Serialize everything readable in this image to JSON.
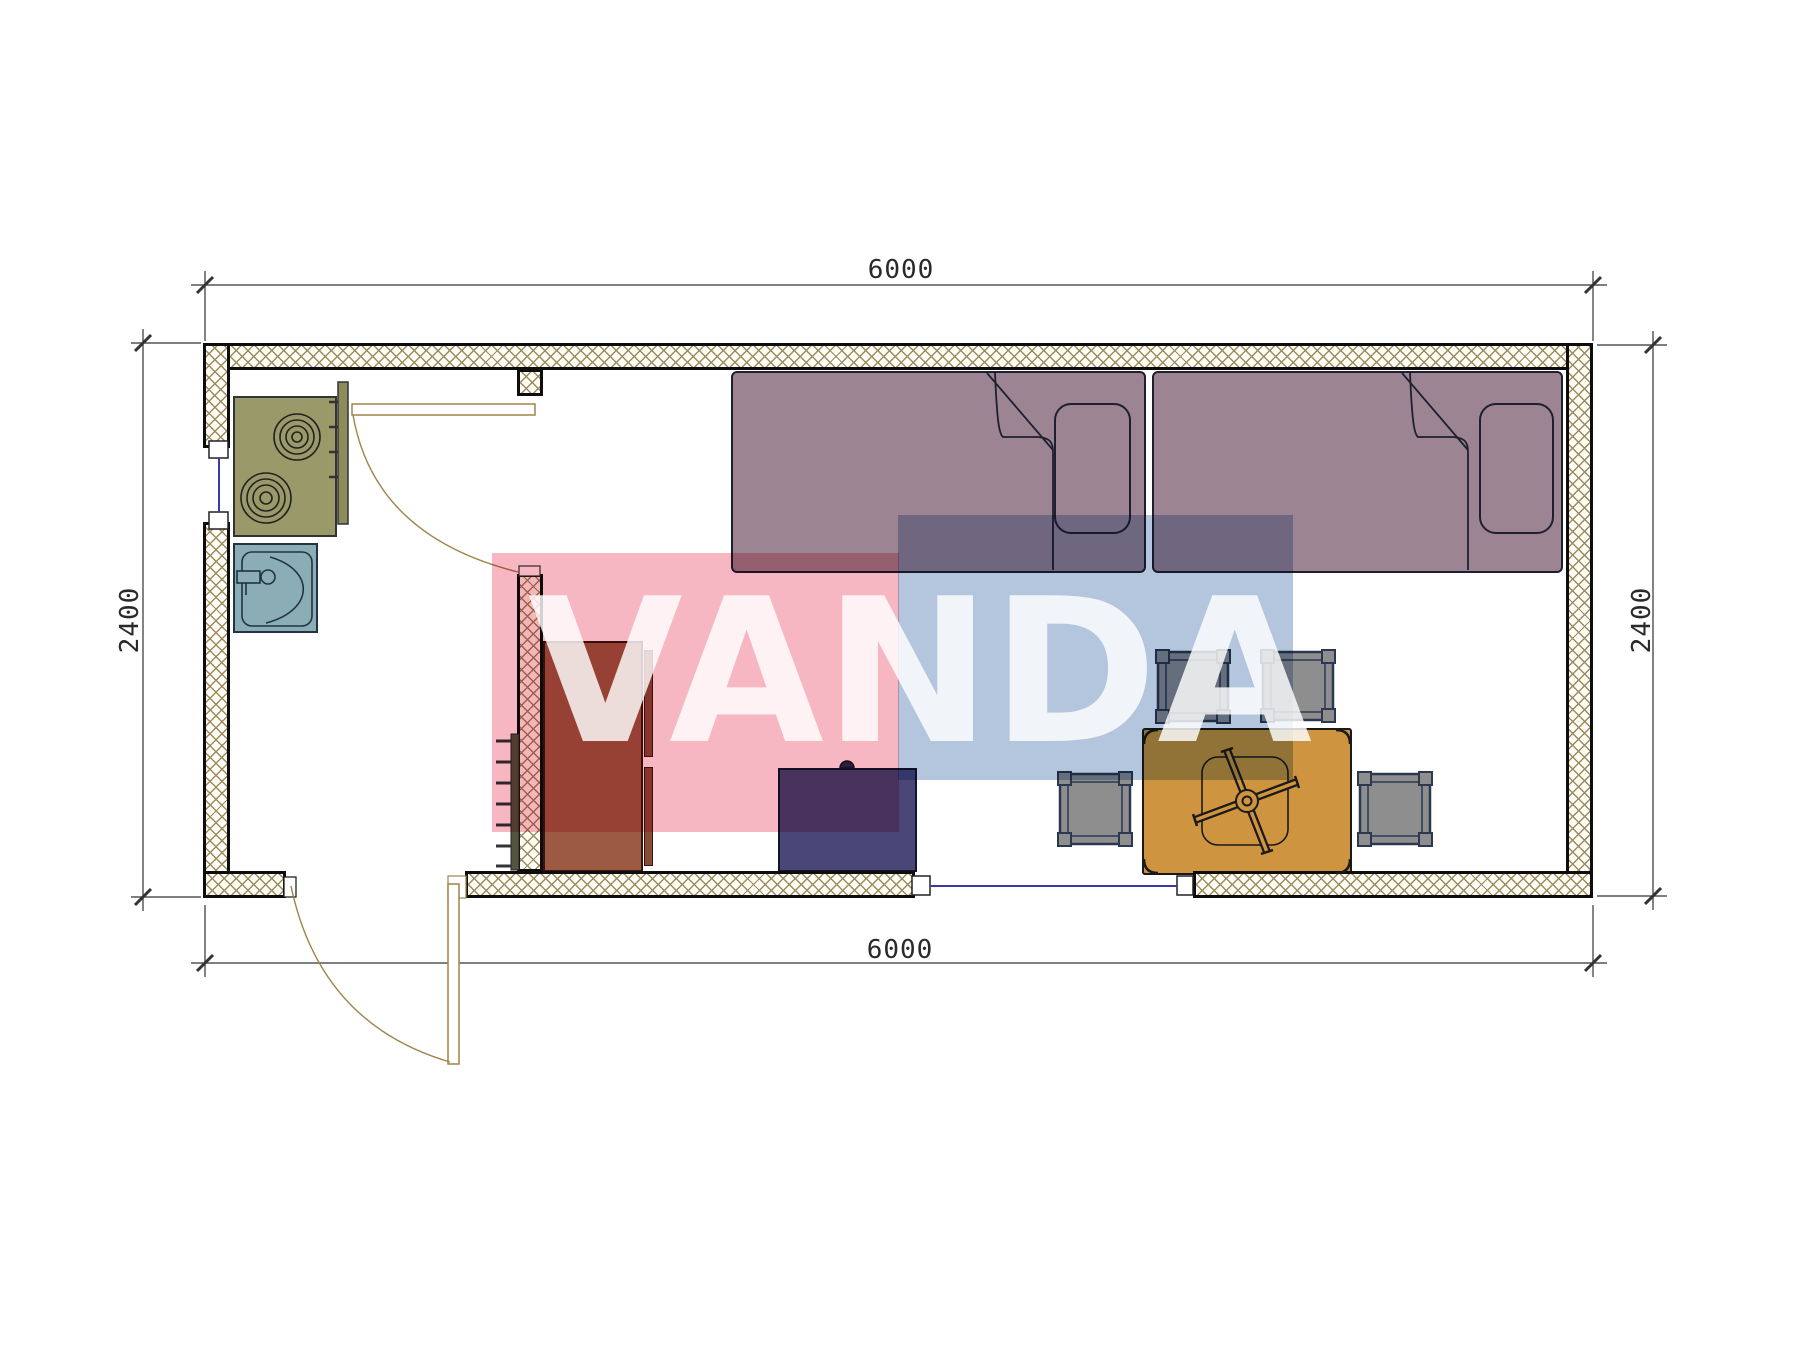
{
  "watermark": {
    "text": "VANDA",
    "pink_color": "#f6b7c3",
    "blue_color": "#b3c6de",
    "text_color": "rgba(255,255,255,0.82)"
  },
  "dimensions": {
    "top": "6000",
    "bottom": "6000",
    "left": "2400",
    "right": "2400"
  },
  "walls": {
    "hatch_color": "#9b8b5e",
    "outline_color": "#0d0d0d"
  },
  "windows": {
    "count": 2,
    "glazing_color": "#3a3aa6"
  },
  "doors": {
    "count": 2,
    "swing_color": "#a08449"
  },
  "furniture": [
    {
      "name": "cooktop-two-burners",
      "color": "#99996a"
    },
    {
      "name": "sink",
      "color": "#8badb6"
    },
    {
      "name": "wardrobe",
      "color": "#9c5a42"
    },
    {
      "name": "dresser",
      "color": "#4a4678"
    },
    {
      "name": "bed-left",
      "color": "#9c8492"
    },
    {
      "name": "bed-right",
      "color": "#9c8492"
    },
    {
      "name": "table-with-fan",
      "color": "#cf9440"
    },
    {
      "name": "stools",
      "count": 4,
      "color": "#8e8e8e"
    },
    {
      "name": "towel-ladder",
      "color": "#55553f"
    }
  ]
}
